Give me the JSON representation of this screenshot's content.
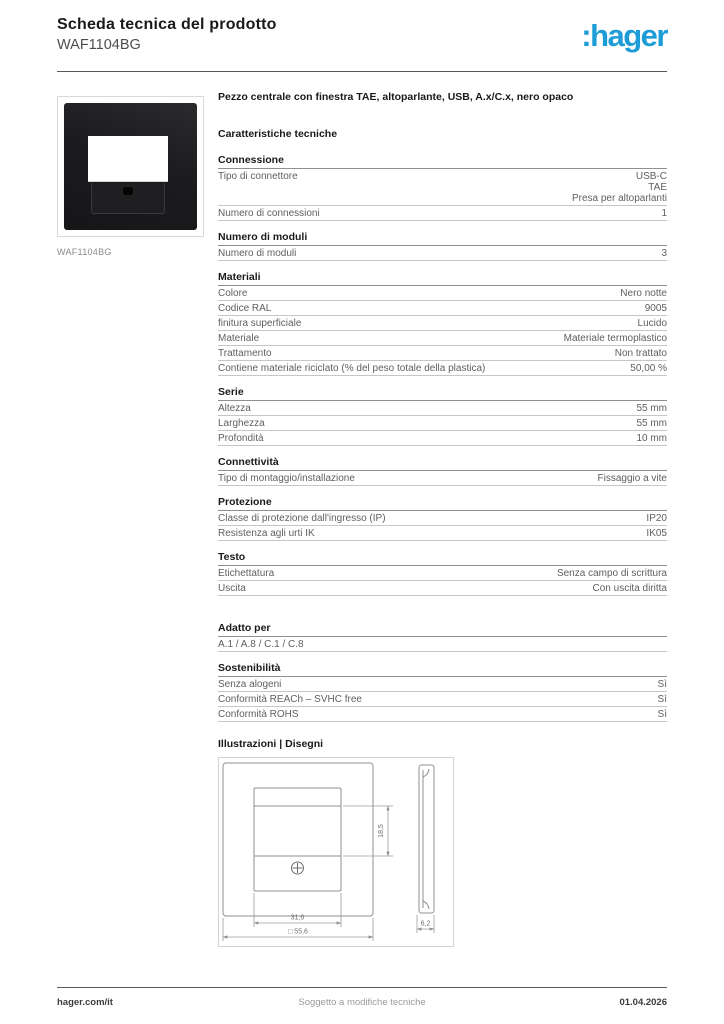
{
  "page": {
    "title": "Scheda tecnica del prodotto",
    "product_code": "WAF1104BG",
    "brand_logo": ":hager",
    "brand_color": "#1E9CD7"
  },
  "product": {
    "image_label": "WAF1104BG",
    "description": "Pezzo centrale con finestra TAE, altoparlante, USB, A.x/C.x, nero opaco"
  },
  "characteristics_heading": "Caratteristiche tecniche",
  "sections": [
    {
      "title": "Connessione",
      "rows": [
        {
          "label": "Tipo di connettore",
          "values": [
            "USB-C",
            "TAE",
            "Presa per altoparlanti"
          ]
        },
        {
          "label": "Numero di connessioni",
          "values": [
            "1"
          ]
        }
      ]
    },
    {
      "title": "Numero di moduli",
      "rows": [
        {
          "label": "Numero di moduli",
          "values": [
            "3"
          ]
        }
      ]
    },
    {
      "title": "Materiali",
      "rows": [
        {
          "label": "Colore",
          "values": [
            "Nero notte"
          ]
        },
        {
          "label": "Codice RAL",
          "values": [
            "9005"
          ]
        },
        {
          "label": "finitura superficiale",
          "values": [
            "Lucido"
          ]
        },
        {
          "label": "Materiale",
          "values": [
            "Materiale termoplastico"
          ]
        },
        {
          "label": "Trattamento",
          "values": [
            "Non trattato"
          ]
        },
        {
          "label": "Contiene materiale riciclato (% del peso totale della plastica)",
          "values": [
            "50,00 %"
          ]
        }
      ]
    },
    {
      "title": "Serie",
      "rows": [
        {
          "label": "Altezza",
          "values": [
            "55 mm"
          ]
        },
        {
          "label": "Larghezza",
          "values": [
            "55 mm"
          ]
        },
        {
          "label": "Profondità",
          "values": [
            "10 mm"
          ]
        }
      ]
    },
    {
      "title": "Connettività",
      "rows": [
        {
          "label": "Tipo di montaggio/installazione",
          "values": [
            "Fissaggio a vite"
          ]
        }
      ]
    },
    {
      "title": "Protezione",
      "rows": [
        {
          "label": "Classe di protezione dall'ingresso (IP)",
          "values": [
            "IP20"
          ]
        },
        {
          "label": "Resistenza agli urti IK",
          "values": [
            "IK05"
          ]
        }
      ]
    },
    {
      "title": "Testo",
      "rows": [
        {
          "label": "Etichettatura",
          "values": [
            "Senza campo di scrittura"
          ]
        },
        {
          "label": "Uscita",
          "values": [
            "Con uscita diritta"
          ]
        }
      ]
    },
    {
      "title": "Adatto per",
      "rows": [
        {
          "label": "A.1 / A.8 / C.1 / C.8",
          "values": []
        }
      ]
    },
    {
      "title": "Sostenibilità",
      "rows": [
        {
          "label": "Senza alogeni",
          "values": [
            "Sì"
          ]
        },
        {
          "label": "Conformità REACh – SVHC free",
          "values": [
            "Sì"
          ]
        },
        {
          "label": "Conformità ROHS",
          "values": [
            "Sì"
          ]
        }
      ]
    }
  ],
  "illustrations": {
    "heading": "Illustrazioni | Disegni",
    "dimensions": {
      "window_height": "18,5",
      "inner_width": "31,6",
      "outer_width": "□ 55,6",
      "depth": "6,2"
    }
  },
  "footer": {
    "website": "hager.com/it",
    "note": "Soggetto a modifiche tecniche",
    "date": "01.04.2026"
  }
}
